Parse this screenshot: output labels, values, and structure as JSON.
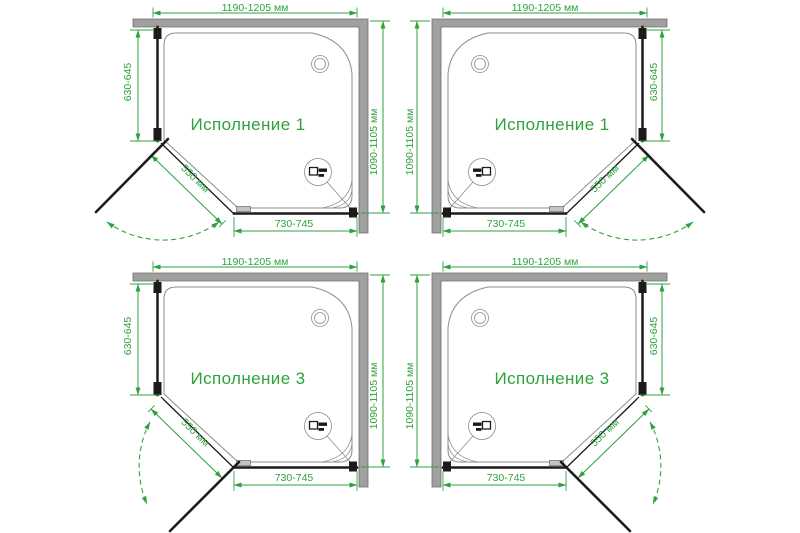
{
  "drawing_title": "Shower enclosure installation variants",
  "colors": {
    "dimension_green": "#2fa23e",
    "wall_gray": "#a0a0a0",
    "line_black": "#1b1b1b",
    "tray_gray": "#8d8d8d",
    "background": "#ffffff"
  },
  "icons": {
    "wall_profile_detail": "profile-detail-callout-icon",
    "shower_head": "shower-head-icon",
    "door_swing": "door-swing-arc-icon"
  },
  "quadrants": [
    {
      "position": "top-left",
      "label": "Исполнение 1",
      "dims": {
        "width": "1190-1205 мм",
        "depth": "1090-1105 мм",
        "side_panel": "630-645",
        "front_panel": "730-745",
        "door": "550 мм"
      }
    },
    {
      "position": "top-right",
      "label": "Исполнение 1",
      "dims": {
        "width": "1190-1205 мм",
        "depth": "1090-1105 мм",
        "side_panel": "630-645",
        "front_panel": "730-745",
        "door": "550 мм"
      }
    },
    {
      "position": "bottom-left",
      "label": "Исполнение 3",
      "dims": {
        "width": "1190-1205 мм",
        "depth": "1090-1105 мм",
        "side_panel": "630-645",
        "front_panel": "730-745",
        "door": "550 мм"
      }
    },
    {
      "position": "bottom-right",
      "label": "Исполнение 3",
      "dims": {
        "width": "1190-1205 мм",
        "depth": "1090-1105 мм",
        "side_panel": "630-645",
        "front_panel": "730-745",
        "door": "550 мм"
      }
    }
  ]
}
